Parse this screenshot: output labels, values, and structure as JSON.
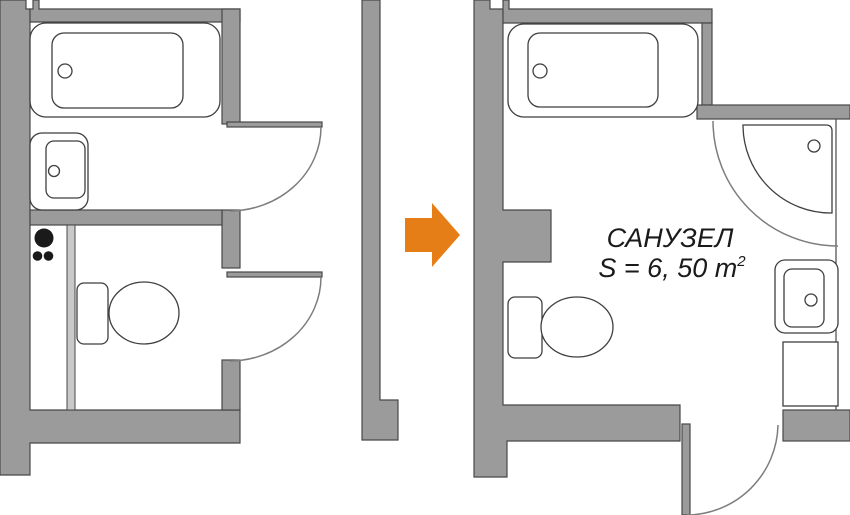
{
  "diagram": {
    "title": "bathroom-remodel-floor-plan-before-after",
    "labels": {
      "room_name": "САНУЗЕЛ",
      "area_value": "S = 6, 50 m",
      "area_superscript": "2"
    },
    "colors": {
      "background": "#FFFFFF",
      "wall_fill": "#9B9B9B",
      "wall_stroke": "#484848",
      "partition_fill": "#C9C9C9",
      "arc_stroke": "#7D7D7D",
      "fixture_fill": "#FFFFFF",
      "fixture_stroke": "#3F3F3F",
      "pipes_fill": "#1A1A1A",
      "arrow_fill": "#E67E17",
      "text_color": "#1A1A1A"
    },
    "before_plan": {
      "fixtures": [
        "bathtub",
        "sink",
        "toilet",
        "pipe-risers"
      ],
      "rooms": 2,
      "doors": 2,
      "partition": true
    },
    "after_plan": {
      "fixtures": [
        "bathtub",
        "corner-shower",
        "toilet",
        "sink",
        "cabinet"
      ],
      "rooms": 1,
      "doors": 1
    },
    "arrow_meaning": "before-to-after"
  }
}
